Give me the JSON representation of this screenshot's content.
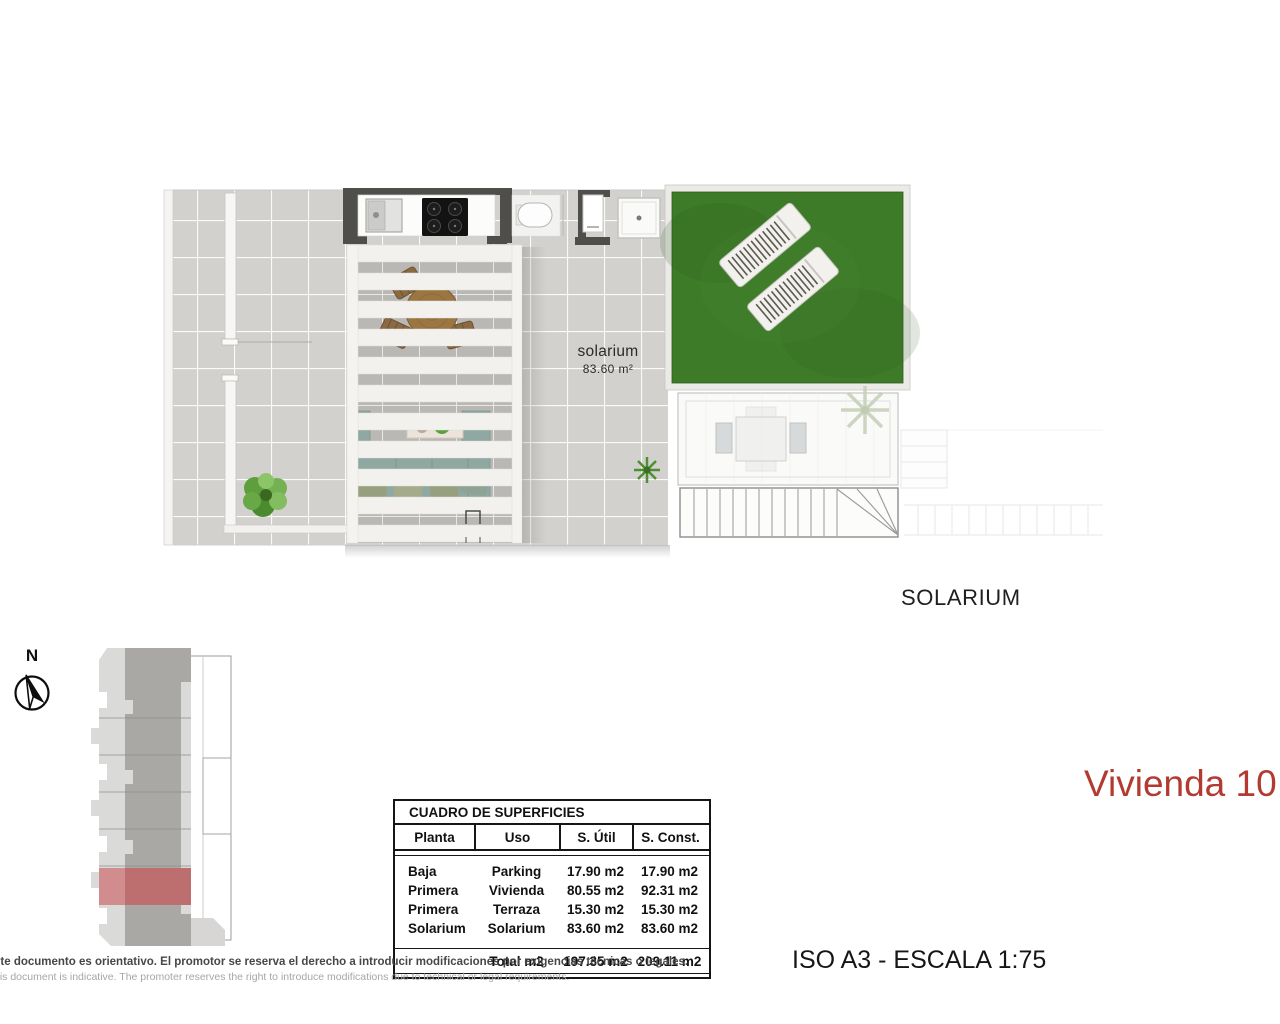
{
  "document": {
    "dwelling_title": "Vivienda 10",
    "format_scale": "ISO A3 - ESCALA 1:75",
    "floor_label": "SOLARIUM",
    "disclaimer_es": "ste documento es orientativo. El promotor se reserva el derecho a introducir modificaciones por exigencias técnicas o legales.",
    "disclaimer_en": "his document is indicative. The promoter reserves the right to introduce modifications due to technical or legal requirements."
  },
  "compass": {
    "north": "N"
  },
  "plan": {
    "room_label": "solarium",
    "room_area": "83.60 m²"
  },
  "surfaces_table": {
    "title": "CUADRO DE SUPERFICIES",
    "columns": [
      "Planta",
      "Uso",
      "S. Útil",
      "S. Const."
    ],
    "rows": [
      [
        "Baja",
        "Parking",
        "17.90 m2",
        "17.90 m2"
      ],
      [
        "Primera",
        "Vivienda",
        "80.55 m2",
        "92.31 m2"
      ],
      [
        "Primera",
        "Terraza",
        "15.30 m2",
        "15.30 m2"
      ],
      [
        "Solarium",
        "Solarium",
        "83.60 m2",
        "83.60 m2"
      ]
    ],
    "total_label": "Total m2",
    "total_util": "197.35 m2",
    "total_const": "209.11 m2"
  },
  "colors": {
    "title_red": "#b23a31",
    "highlight_unit_red": "#c07272",
    "grass_green": "#3e7b28",
    "wall_dark": "#4f4e4b",
    "tile_gray": "#d2d1ce"
  }
}
